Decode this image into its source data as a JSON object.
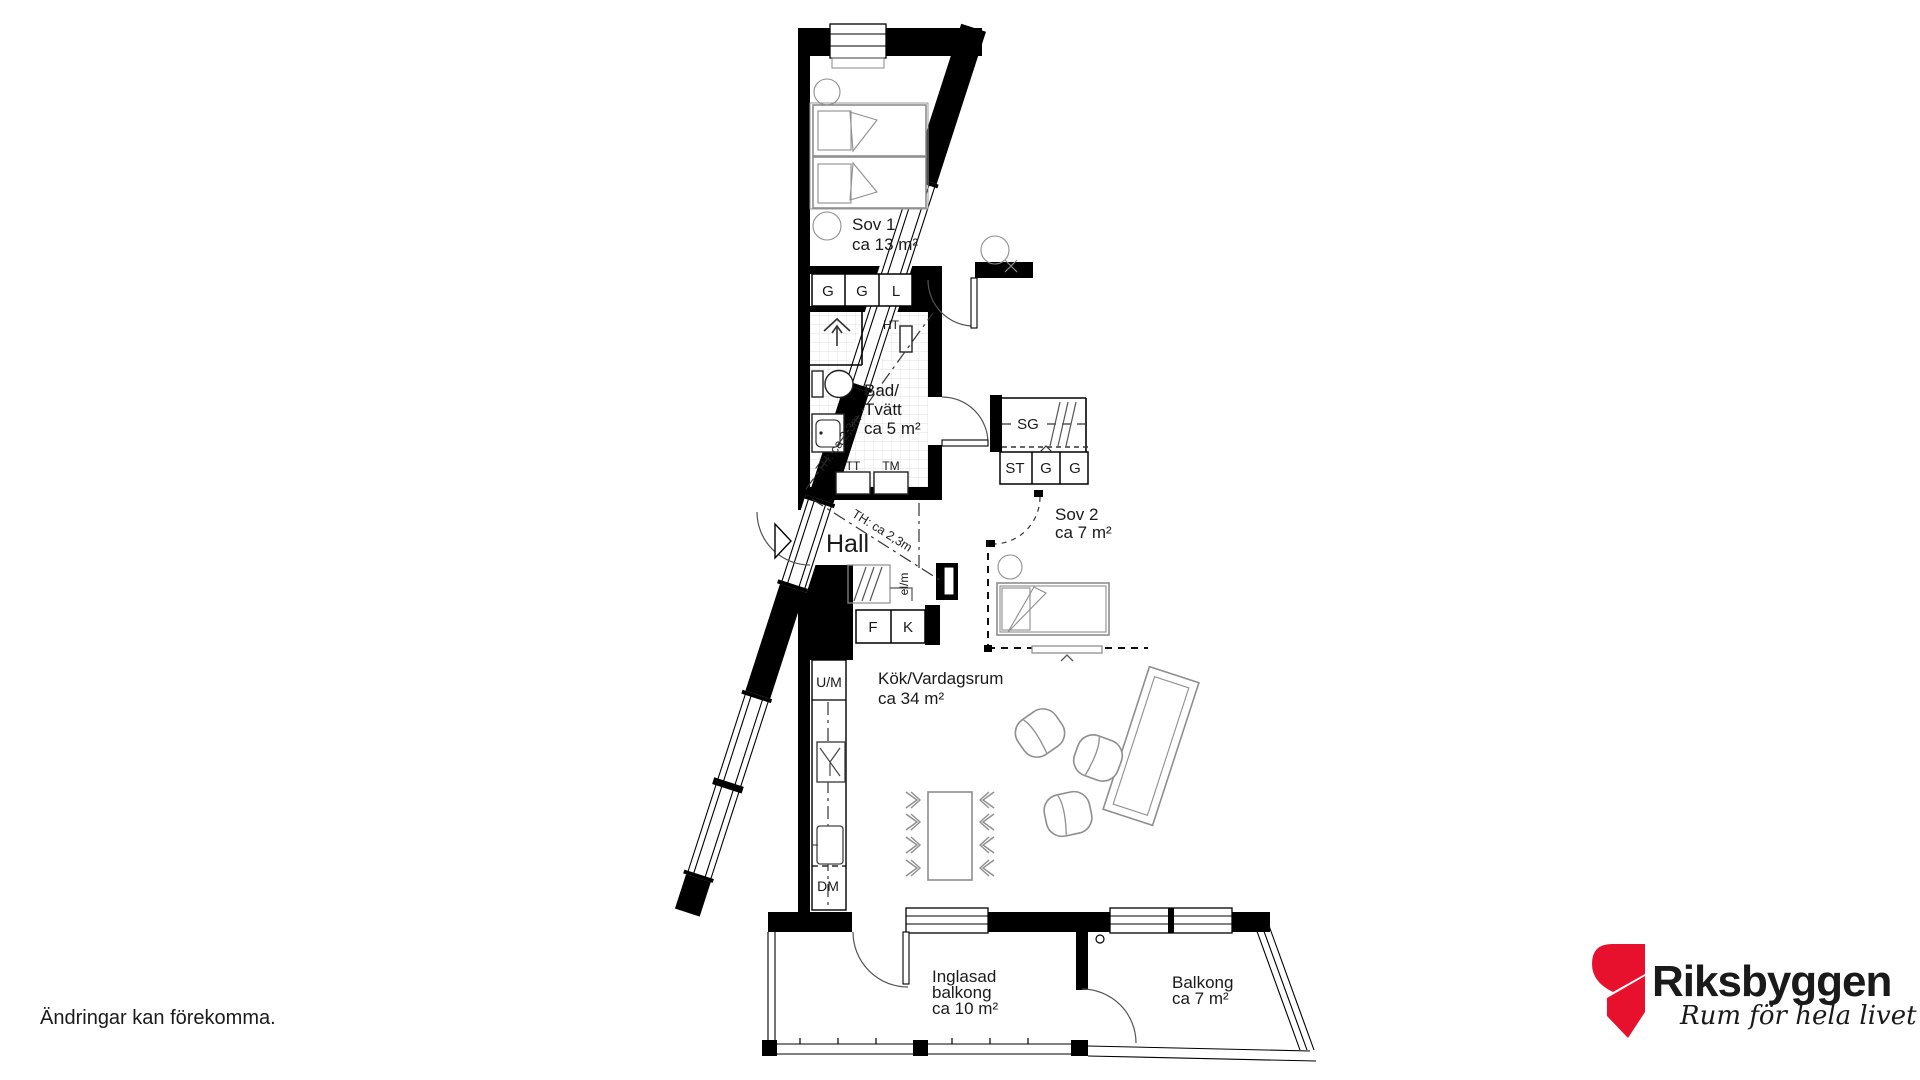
{
  "disclaimer": "Ändringar kan förekomma.",
  "logo": {
    "brand": "Riksbyggen",
    "tagline": "Rum för hela livet",
    "brand_color": "#97979b",
    "mark_color": "#e8112d"
  },
  "rooms": {
    "sov1": {
      "name": "Sov 1",
      "area": "ca 13 m²"
    },
    "bad": {
      "name_line1": "Bad/",
      "name_line2": "Tvätt",
      "area": "ca 5 m²"
    },
    "hall": {
      "name": "Hall"
    },
    "sov2": {
      "name": "Sov 2",
      "area": "ca 7 m²"
    },
    "kok": {
      "name": "Kök/Vardagsrum",
      "area": "ca 34 m²"
    },
    "inglasad_balkong": {
      "name_line1": "Inglasad",
      "name_line2": "balkong",
      "area": "ca 10 m²"
    },
    "balkong": {
      "name": "Balkong",
      "area": "ca 7 m²"
    }
  },
  "fixtures": {
    "wardrobe_1": "G",
    "wardrobe_2": "G",
    "linen_closet": "L",
    "towel_dryer": "HT",
    "dryer": "TT",
    "washing_machine": "TM",
    "sliding_wardrobe": "SG",
    "cleaning_closet": "ST",
    "wardrobe_3": "G",
    "wardrobe_4": "G",
    "freezer": "F",
    "fridge": "K",
    "oven_micro": "U/M",
    "dishwasher": "DM",
    "el_meter": "el/m",
    "ceiling_height_bath": "TH: ca 2,3m",
    "ceiling_height_hall": "TH: ca 2,3m"
  }
}
